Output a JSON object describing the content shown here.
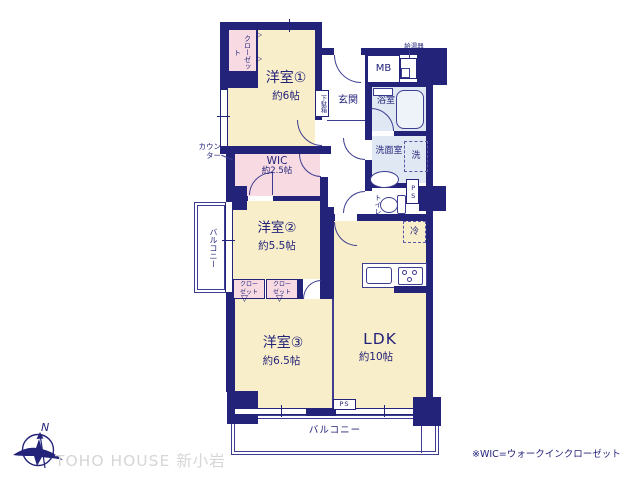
{
  "colors": {
    "wall_navy": "#23237a",
    "room_cream": "#f8eeca",
    "closet_pink": "#f8dbe2",
    "wet_blue": "#dfe8f3",
    "watermark_gray": "#d6d6d6"
  },
  "rooms": {
    "r1": {
      "name": "洋室①",
      "size": "約6帖"
    },
    "wic": {
      "name": "WIC",
      "size": "約2.5帖"
    },
    "r2": {
      "name": "洋室②",
      "size": "約5.5帖"
    },
    "r3": {
      "name": "洋室③",
      "size": "約6.5帖"
    },
    "ldk": {
      "name": "LDK",
      "size": "約10帖"
    }
  },
  "labels": {
    "closet": "クローゼット",
    "counter": "カウンター",
    "shoe_box": "下駄箱",
    "entrance": "玄関",
    "meter_box": "MB",
    "water_heater": "給湯器",
    "bathroom": "浴室",
    "washroom": "洗面室",
    "washer": "洗",
    "toilet": "トイレ",
    "pipe_space": "PS",
    "fridge": "冷",
    "balcony": "バルコニー",
    "north": "N"
  },
  "note": "※WIC=ウォークインクローゼット",
  "watermark": "TOHO HOUSE 新小岩"
}
